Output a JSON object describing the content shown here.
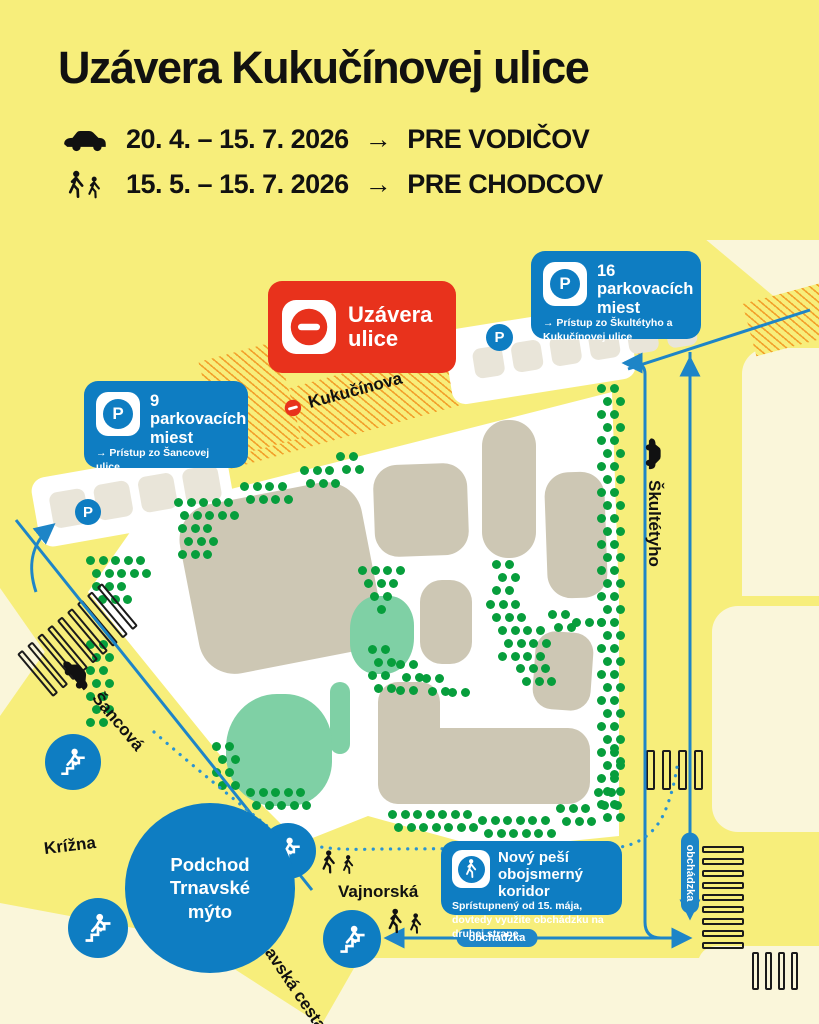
{
  "header": {
    "title": "Uzávera Kukučínovej ulice",
    "schedule": [
      {
        "dates": "20. 4. – 15. 7. 2026",
        "arrow": "→",
        "audience": "PRE VODIČOV"
      },
      {
        "dates": "15. 5. – 15. 7. 2026",
        "arrow": "→",
        "audience": "PRE CHODCOV"
      }
    ]
  },
  "closure_badge": {
    "line1": "Uzávera",
    "line2": "ulice"
  },
  "parking_badges": [
    {
      "title": "16 parkovacích miest",
      "access": "→ Prístup zo Škultétyho a Kukučínovej ulice",
      "letter": "P"
    },
    {
      "title": "9 parkovacích miest",
      "access": "→ Prístup zo Šancovej ulice",
      "letter": "P"
    }
  ],
  "corridor_badge": {
    "title": "Nový peší obojsmerný koridor",
    "note": "Sprístupnený od 15. mája, dovtedy využite obchádzku na druhej strane."
  },
  "underpass": {
    "line1": "Podchod",
    "line2": "Trnavské",
    "line3": "mýto"
  },
  "streets": {
    "kukucinova": "Kukučínova",
    "skultetyho": "Škultétyho",
    "sancova": "Šancová",
    "krizna": "Krížna",
    "vajnorska": "Vajnorská",
    "trnavska": "Trnavská cesta"
  },
  "detour_label": "obchádzka",
  "parking_letter": "P",
  "colors": {
    "yellow": "#f7ee7b",
    "cream": "#faf6da",
    "blue": "#0e7dc2",
    "line_blue": "#1e85c7",
    "red": "#e8321c",
    "building": "#cdc7b4",
    "teal": "#7fd0a5",
    "tree": "#079e3c",
    "black": "#161616"
  },
  "map": {
    "tree_clusters": [
      [
        597,
        384,
        2,
        34
      ],
      [
        174,
        498,
        5,
        2
      ],
      [
        178,
        524,
        3,
        3
      ],
      [
        240,
        482,
        4,
        2
      ],
      [
        300,
        466,
        3,
        2
      ],
      [
        336,
        452,
        2,
        2
      ],
      [
        86,
        556,
        5,
        2
      ],
      [
        92,
        582,
        3,
        2
      ],
      [
        86,
        640,
        2,
        7
      ],
      [
        358,
        566,
        4,
        1
      ],
      [
        364,
        579,
        3,
        1
      ],
      [
        370,
        592,
        2,
        1
      ],
      [
        377,
        605,
        1,
        1
      ],
      [
        492,
        560,
        2,
        3
      ],
      [
        486,
        600,
        3,
        2
      ],
      [
        498,
        626,
        4,
        3
      ],
      [
        516,
        664,
        3,
        2
      ],
      [
        548,
        610,
        2,
        2
      ],
      [
        572,
        618,
        3,
        1
      ],
      [
        368,
        645,
        2,
        4
      ],
      [
        396,
        660,
        2,
        3
      ],
      [
        422,
        674,
        2,
        2
      ],
      [
        448,
        688,
        2,
        1
      ],
      [
        212,
        742,
        2,
        4
      ],
      [
        246,
        788,
        5,
        2
      ],
      [
        388,
        810,
        7,
        2
      ],
      [
        478,
        816,
        6,
        2
      ],
      [
        556,
        804,
        3,
        2
      ],
      [
        594,
        788,
        2,
        2
      ],
      [
        610,
        744,
        1,
        3
      ]
    ],
    "buildings": [
      [
        188,
        492,
        185,
        172,
        36,
        -11
      ],
      [
        374,
        464,
        94,
        92,
        24,
        -2
      ],
      [
        482,
        420,
        54,
        138,
        26,
        0
      ],
      [
        546,
        472,
        60,
        126,
        24,
        -2
      ],
      [
        420,
        580,
        52,
        84,
        22,
        0
      ],
      [
        534,
        632,
        58,
        78,
        20,
        4
      ],
      [
        378,
        682,
        62,
        122,
        20,
        0
      ],
      [
        378,
        728,
        212,
        76,
        22,
        0
      ]
    ],
    "teal_areas": [
      [
        350,
        596,
        64,
        78,
        "42% 38% 46% 40%"
      ],
      [
        330,
        682,
        20,
        72,
        "10px"
      ],
      [
        226,
        694,
        106,
        112,
        "48% 44% 40% 46%"
      ]
    ],
    "crosswalks": [
      [
        22,
        612,
        9,
        7,
        56,
        6,
        -40,
        false
      ],
      [
        646,
        750,
        4,
        9,
        40,
        7,
        0,
        false
      ],
      [
        702,
        846,
        9,
        42,
        7,
        5,
        0,
        true
      ],
      [
        752,
        952,
        4,
        7,
        38,
        6,
        0,
        false
      ]
    ],
    "parking_strips": [
      [
        34,
        462,
        198,
        70,
        -10,
        4,
        36,
        16
      ],
      [
        447,
        316,
        186,
        76,
        -9,
        6,
        30,
        26
      ]
    ]
  }
}
